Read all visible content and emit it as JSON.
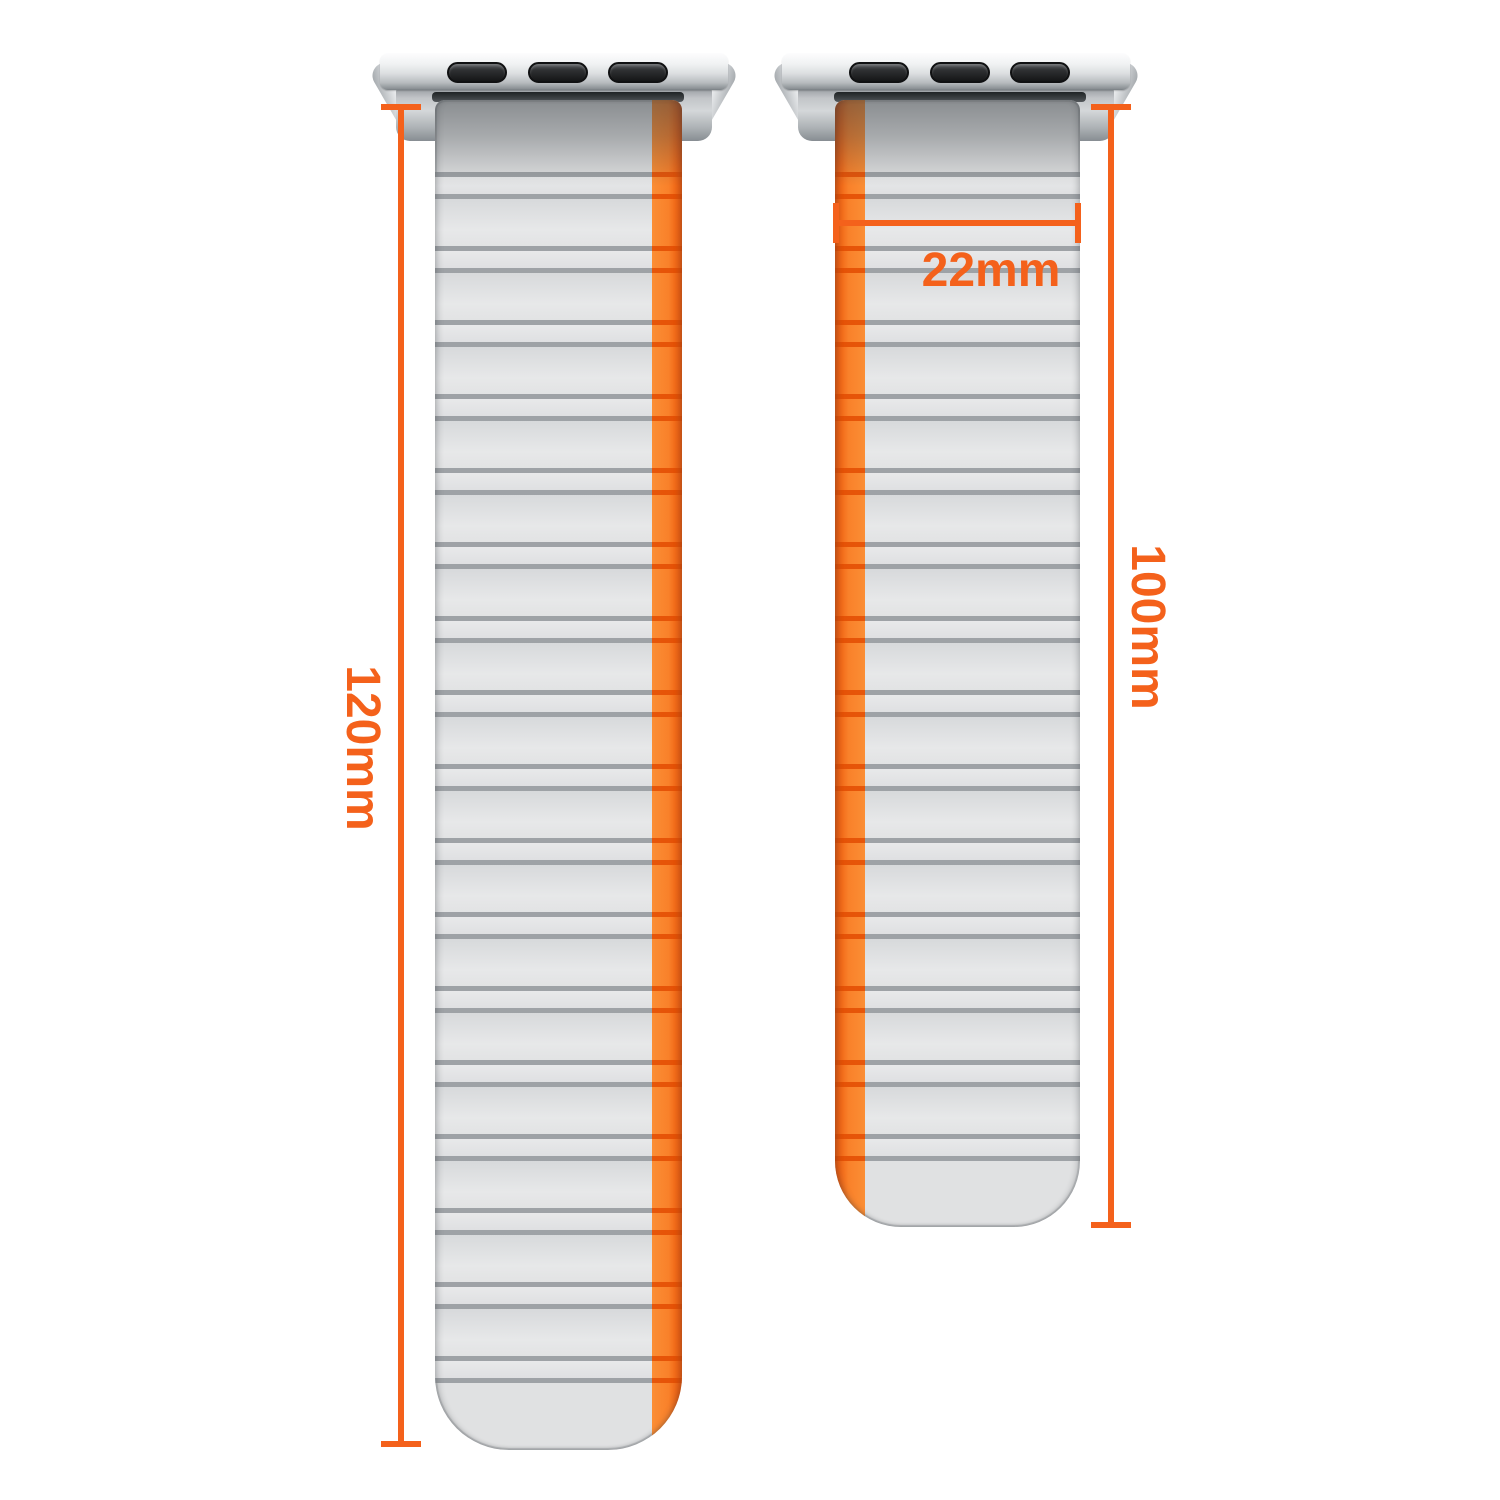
{
  "canvas": {
    "width": 1500,
    "height": 1500,
    "background": "#FFFFFF"
  },
  "palette": {
    "accent_orange": "#F4611B",
    "stripe_orange": "#F9812A",
    "stripe_ridge_orange": "#E24C02",
    "band_gray": "#E0E1E2",
    "ridge_gray": "#9EA2A6",
    "adapter_silver": "#D5D8DA",
    "slot_black": "#1A1B1C",
    "slit_dark": "#2E3134"
  },
  "bands": {
    "long_band": {
      "length_label": "120mm",
      "stripe_side": "right"
    },
    "short_band": {
      "length_label": "100mm",
      "width_label": "22mm",
      "stripe_side": "left"
    }
  },
  "dimensions": {
    "long_length": "120mm",
    "short_length": "100mm",
    "band_width": "22mm"
  }
}
